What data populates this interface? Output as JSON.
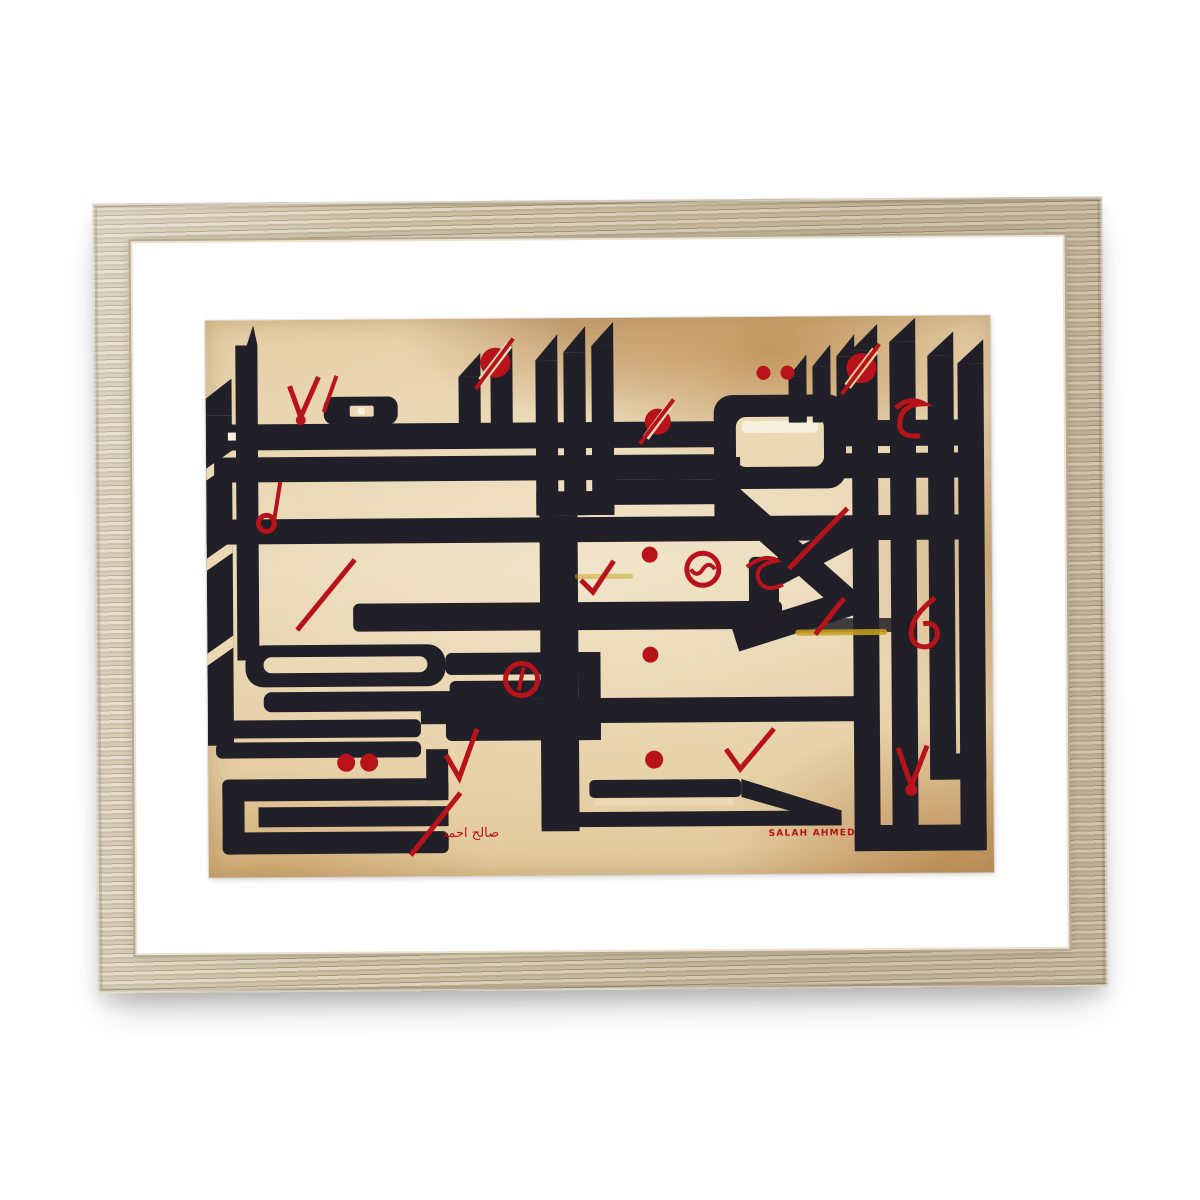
{
  "meta": {
    "description": "Photograph of a framed art print: geometric square-Kufic Arabic calligraphy in black ink with red diacritical marks on stained parchment, natural light-wood frame with white mat"
  },
  "artwork": {
    "script_style": "square-kufic-calligraphy",
    "signature_arabic": "صالح احمد",
    "signature_latin": "SALAH AHMED"
  },
  "colors": {
    "backdrop": "#ffffff",
    "mat": "#ffffff",
    "wood": "#cdc0a7",
    "woodDark": "#a8967b",
    "woodLight": "#e0d6c2",
    "ink": "#211f28",
    "red": "#b8121a",
    "paperLight": "#ecddbf",
    "paperStain": "#c08a44"
  }
}
